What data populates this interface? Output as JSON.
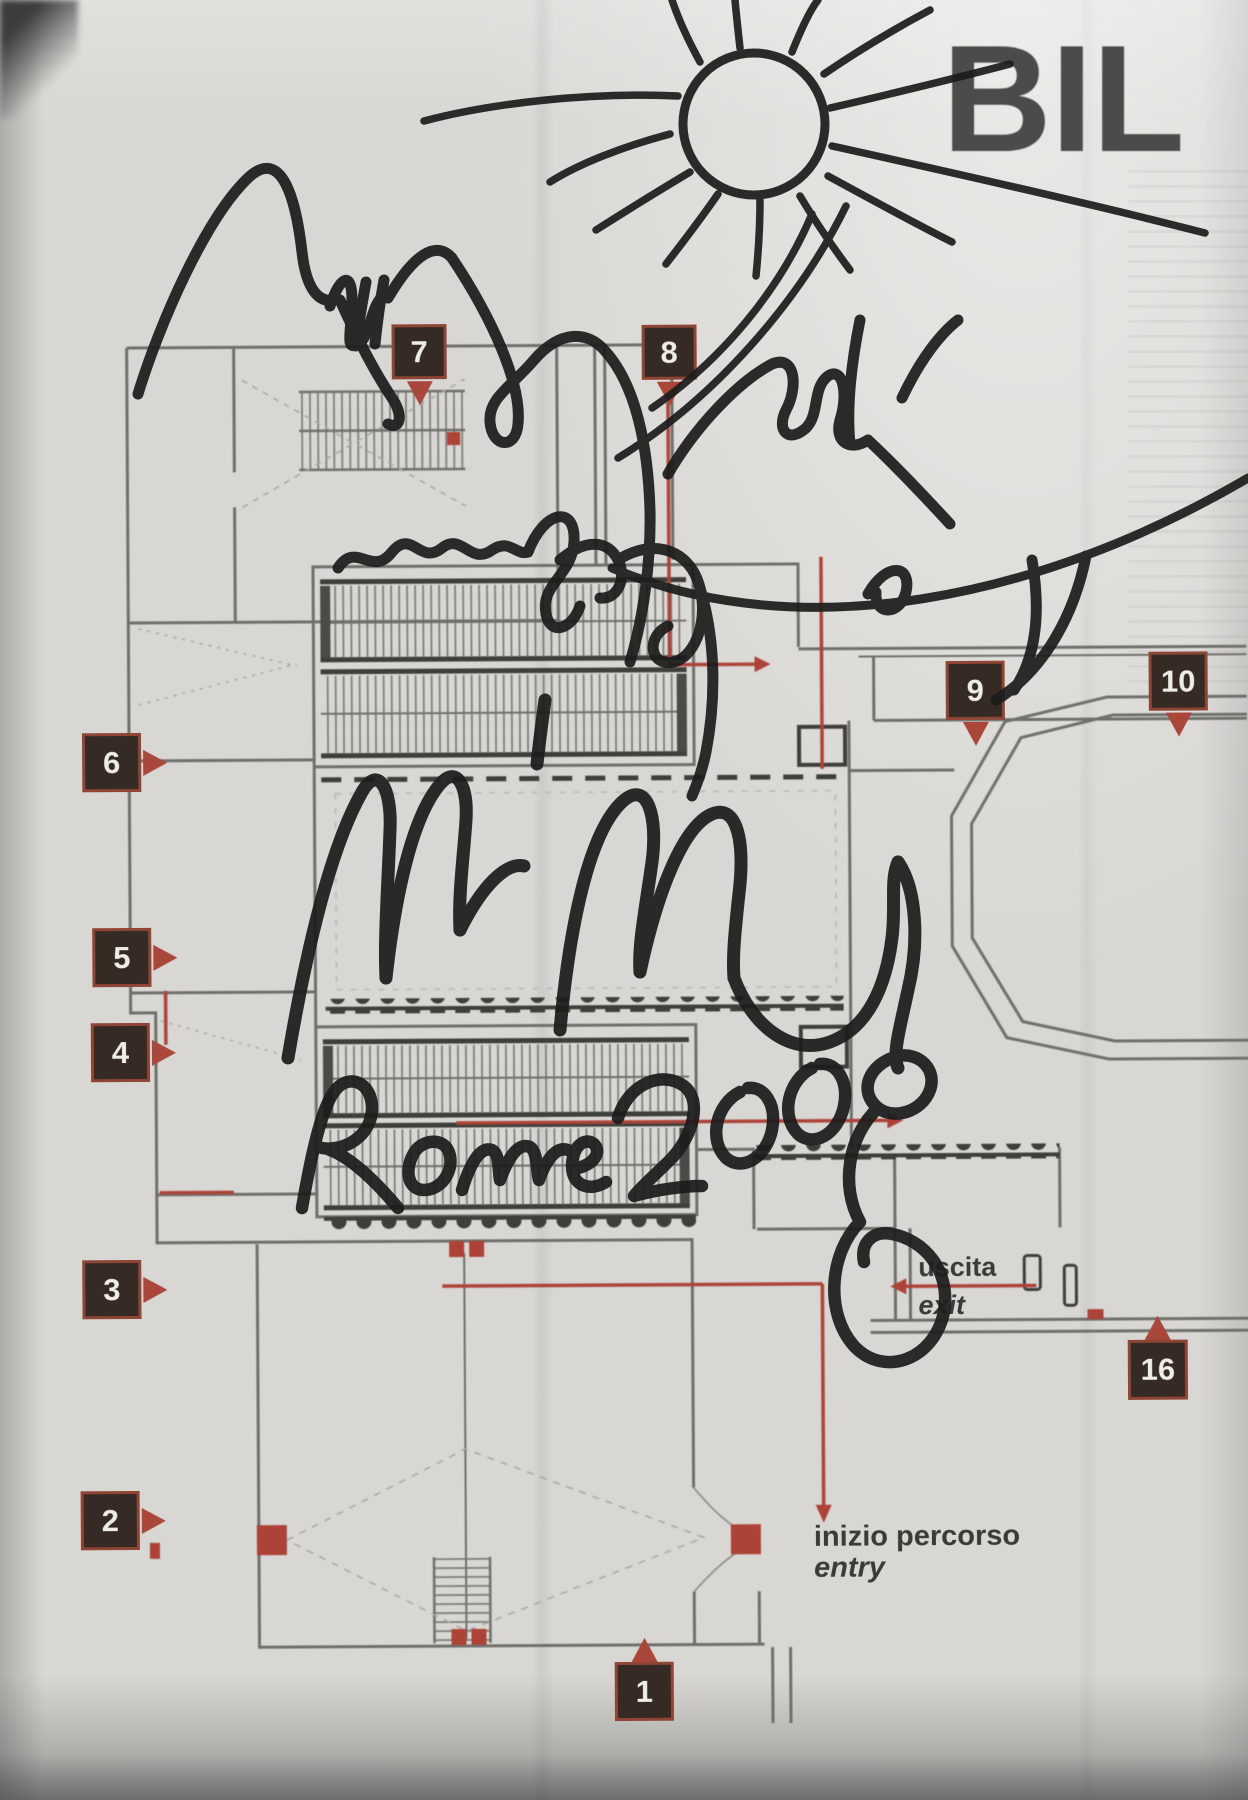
{
  "page": {
    "heading_clipped": "BIL",
    "description": "photographed exhibition floor-plan page with autograph"
  },
  "plan": {
    "legend": {
      "uscita_label": "uscita",
      "exit_label": "exit",
      "inizio_label": "inizio percorso",
      "entry_label": "entry"
    },
    "markers": [
      {
        "label": "1"
      },
      {
        "label": "2"
      },
      {
        "label": "3"
      },
      {
        "label": "4"
      },
      {
        "label": "5"
      },
      {
        "label": "6"
      },
      {
        "label": "7"
      },
      {
        "label": "8"
      },
      {
        "label": "9"
      },
      {
        "label": "10"
      },
      {
        "label": "16"
      }
    ],
    "colors": {
      "paper": "#d8d7d3",
      "wall_gray": "#6f6f6b",
      "dark_detail": "#3f3f3a",
      "route_red": "#ad4338",
      "marker_bg": "#352a24",
      "marker_border": "#9e4a38",
      "heading_gray": "#4b4b4b",
      "ink_black": "#1d1d1d"
    }
  },
  "annotations": {
    "handwriting_text": "Rome 2008",
    "drawing": "sun doodle with rays and signature scribbles in black marker"
  }
}
